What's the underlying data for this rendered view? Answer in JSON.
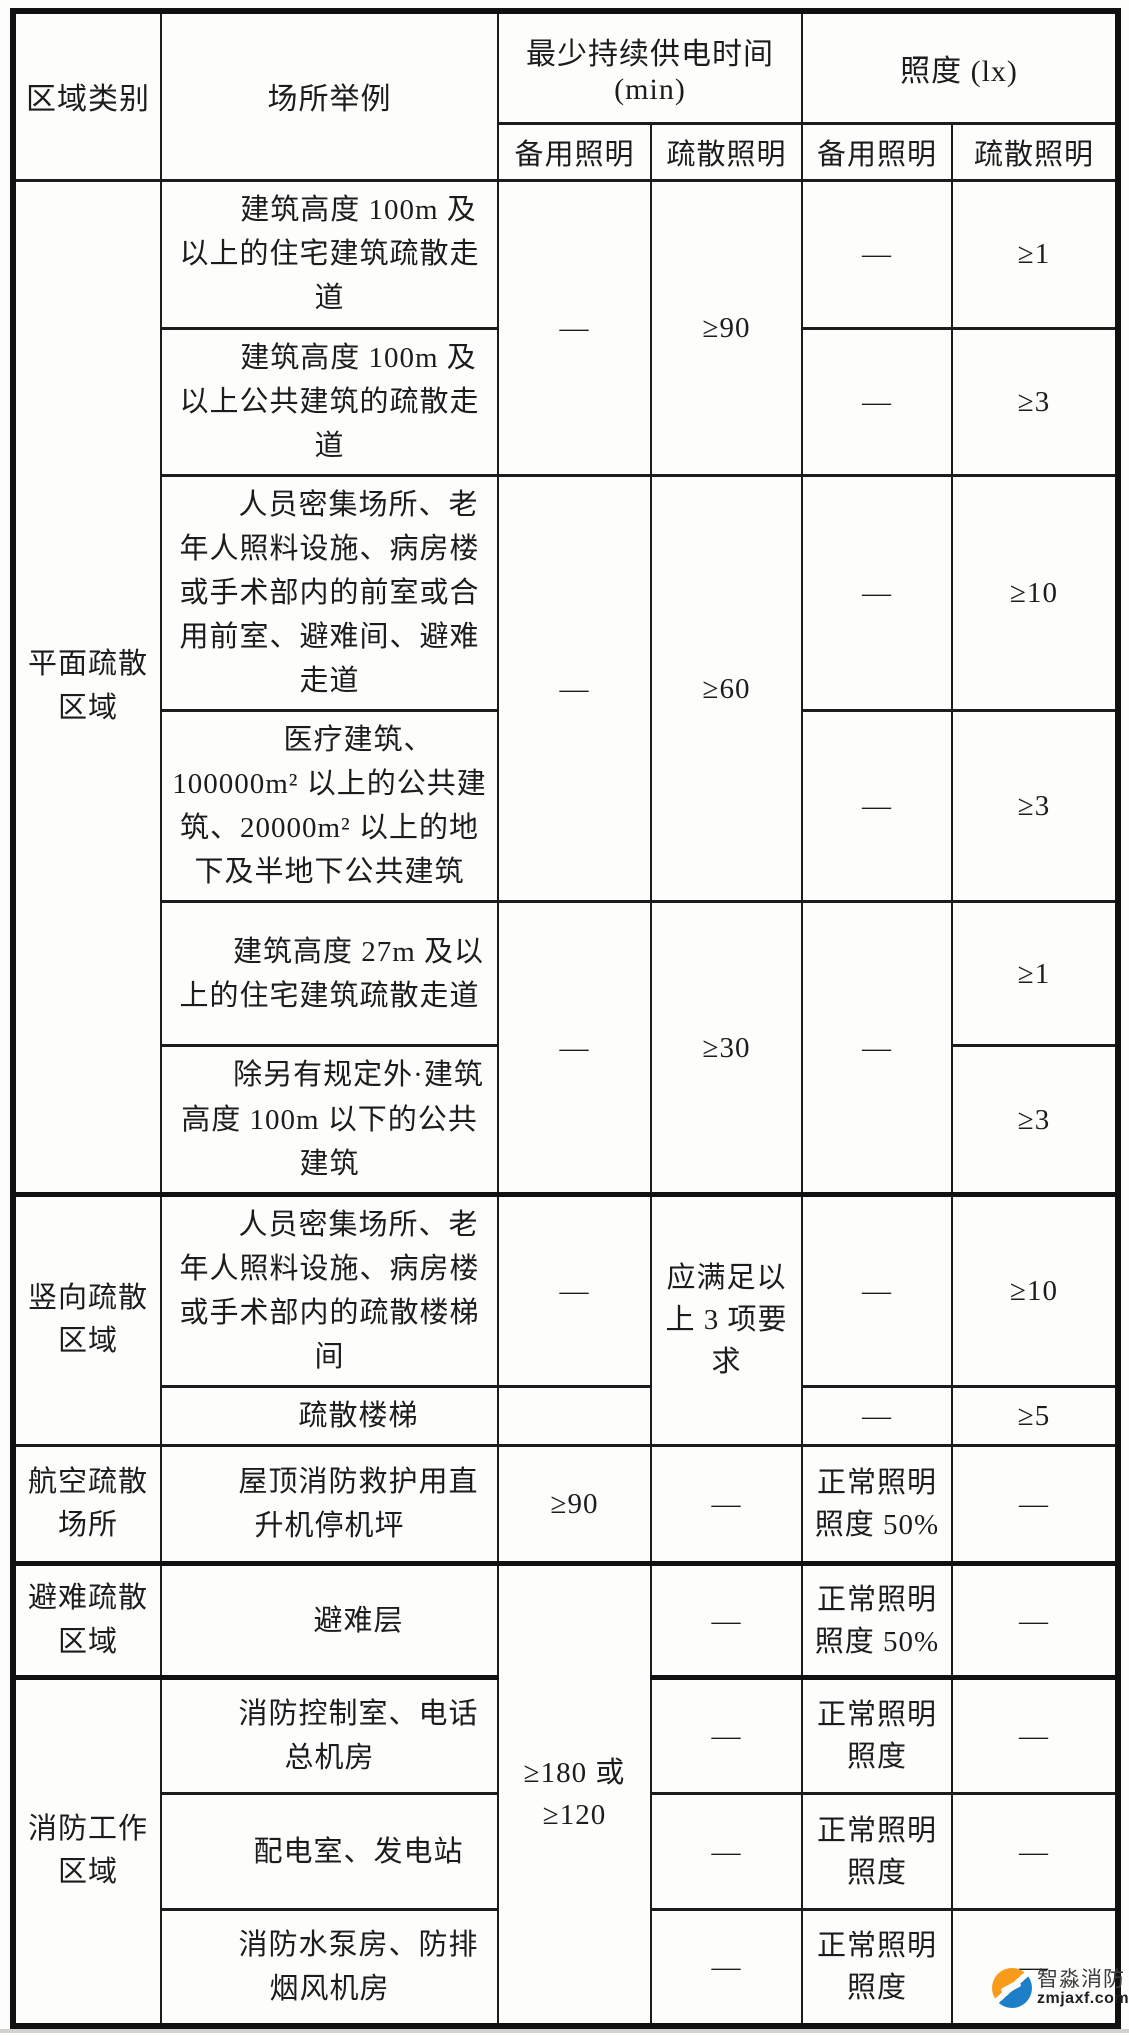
{
  "header": {
    "area": "区域类别",
    "place": "场所举例",
    "time_group": "最少持续供电时间\n(min)",
    "lux_group": "照度 (lx)",
    "backup": "备用照明",
    "evac": "疏散照明"
  },
  "rows": {
    "r1": {
      "area": "平面疏散\n区域",
      "place": "建筑高度 100m 及以上的住宅建筑疏散走道",
      "t_backup": "—",
      "t_evac": "≥90",
      "l_backup": "—",
      "l_evac": "≥1"
    },
    "r2": {
      "place": "建筑高度 100m 及以上公共建筑的疏散走道",
      "l_backup": "—",
      "l_evac": "≥3"
    },
    "r3": {
      "place": "人员密集场所、老年人照料设施、病房楼或手术部内的前室或合用前室、避难间、避难走道",
      "t_backup": "—",
      "t_evac": "≥60",
      "l_backup": "—",
      "l_evac": "≥10"
    },
    "r4": {
      "place": "医疗建筑、100000m² 以上的公共建筑、20000m² 以上的地下及半地下公共建筑",
      "l_backup": "—",
      "l_evac": "≥3"
    },
    "r5": {
      "place": "建筑高度 27m 及以上的住宅建筑疏散走道",
      "t_backup": "—",
      "t_evac": "≥30",
      "l_backup": "—",
      "l_evac": "≥1"
    },
    "r6": {
      "place": "除另有规定外·建筑高度 100m 以下的公共建筑",
      "l_evac": "≥3"
    },
    "r7": {
      "area": "竖向疏散\n区域",
      "place": "人员密集场所、老年人照料设施、病房楼或手术部内的疏散楼梯间",
      "t_backup": "—",
      "t_evac": "应满足以\n上 3 项要求",
      "l_backup": "—",
      "l_evac": "≥10"
    },
    "r8": {
      "place": "疏散楼梯",
      "l_backup": "—",
      "l_evac": "≥5"
    },
    "r9": {
      "area": "航空疏散\n场所",
      "place": "屋顶消防救护用直升机停机坪",
      "t_backup": "≥90",
      "t_evac": "—",
      "l_backup": "正常照明\n照度 50%",
      "l_evac": "—"
    },
    "r10": {
      "area": "避难疏散\n区域",
      "place": "避难层",
      "t_backup": "≥180 或\n≥120",
      "t_evac": "—",
      "l_backup": "正常照明\n照度 50%",
      "l_evac": "—"
    },
    "r11": {
      "area": "消防工作\n区域",
      "place": "消防控制室、电话总机房",
      "t_evac": "—",
      "l_backup": "正常照明\n照度",
      "l_evac": "—"
    },
    "r12": {
      "place": "配电室、发电站",
      "t_evac": "—",
      "l_backup": "正常照明\n照度",
      "l_evac": "—"
    },
    "r13": {
      "place": "消防水泵房、防排烟风机房",
      "t_evac": "—",
      "l_backup": "正常照明\n照度",
      "l_evac": "—"
    }
  },
  "watermark": {
    "brand": "智淼消防",
    "site": "zmjaxf.com",
    "logo_orange": "#f89b1b",
    "logo_blue": "#1e7fc9"
  }
}
